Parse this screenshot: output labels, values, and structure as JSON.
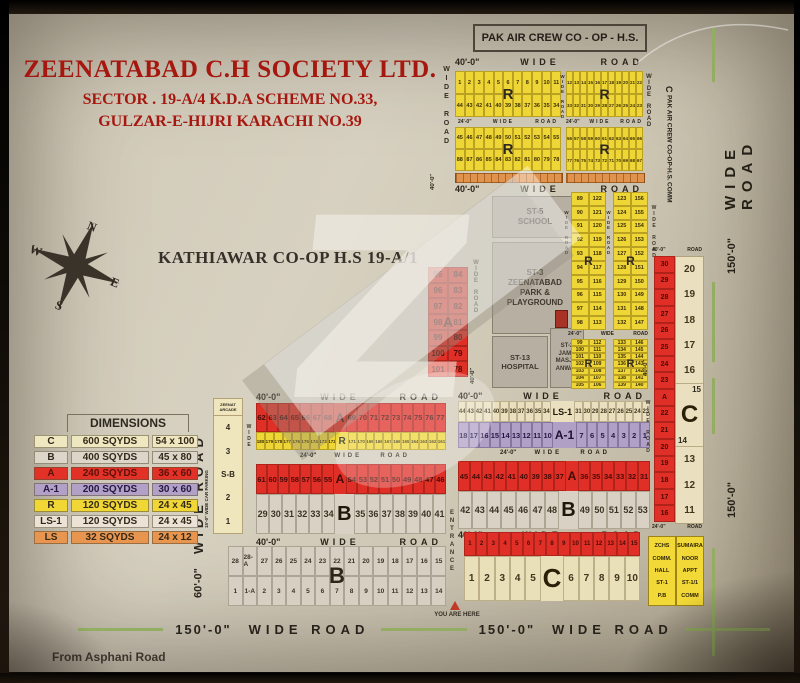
{
  "title": {
    "line1": "ZEENATABAD C.H SOCIETY LTD.",
    "line2": "SECTOR . 19-A/4 K.D.A SCHEME NO.33,",
    "line3": "GULZAR-E-HIJRI KARACHI NO.39"
  },
  "landmarks": {
    "pak_air": "PAK AIR CREW CO - OP - H.S.",
    "pak_air_comm_c": "C",
    "pak_air_comm": "PAK AIR CREW CO-OP-H.S.",
    "pak_air_comm2": "COMM",
    "kathiawar": "KATHIAWAR CO-OP H.S 19-A/1",
    "from_road": "From Asphani Road",
    "you_are_here": "YOU ARE HERE",
    "entrance": "ENTRANCE",
    "watermark": "Z"
  },
  "roads": {
    "wide_road": "WIDE ROAD",
    "wide": "WIDE",
    "road": "ROAD",
    "d40": "40'-0\"",
    "d24": "24'-0\"",
    "d60": "60'-0\"",
    "d150": "150'-0\"",
    "parking": "15'-0\" WIDE CAR PARKING"
  },
  "compass": {
    "n": "N",
    "e": "E",
    "s": "S",
    "w": "W"
  },
  "legend": {
    "title": "DIMENSIONS",
    "rows": [
      {
        "code": "C",
        "area": "600 SQYDS",
        "size": "54 x 100",
        "color": "#efe7c0"
      },
      {
        "code": "B",
        "area": "400 SQYDS",
        "size": "45 x 80",
        "color": "#dcd5c9"
      },
      {
        "code": "A",
        "area": "240 SQYDS",
        "size": "36 x 60",
        "color": "#e23127"
      },
      {
        "code": "A-1",
        "area": "200 SQYDS",
        "size": "30 x 60",
        "color": "#b2a0c6"
      },
      {
        "code": "R",
        "area": "120 SQYDS",
        "size": "24 x 45",
        "color": "#f0d735"
      },
      {
        "code": "LS-1",
        "area": "120 SQYDS",
        "size": "24 x 45",
        "color": "#ece3d6"
      },
      {
        "code": "LS",
        "area": "32 SQYDS",
        "size": "24 x 12",
        "color": "#e8964f"
      }
    ]
  },
  "top_r": [
    {
      "label": "R",
      "row1": [
        1,
        2,
        3,
        4,
        5,
        6,
        7,
        8,
        9,
        10,
        11
      ],
      "row2": [
        44,
        43,
        42,
        41,
        40,
        39,
        38,
        37,
        36,
        35,
        34
      ]
    },
    {
      "label": "R",
      "row1": [
        12,
        13,
        14,
        15,
        16,
        17,
        18,
        19,
        20,
        21,
        22
      ],
      "row2": [
        33,
        32,
        31,
        30,
        29,
        28,
        27,
        26,
        25,
        24,
        23
      ]
    },
    {
      "label": "R",
      "row1": [
        45,
        46,
        47,
        48,
        49,
        50,
        51,
        52,
        53,
        54,
        55
      ],
      "row2": [
        88,
        87,
        86,
        85,
        84,
        83,
        82,
        81,
        80,
        79,
        78
      ]
    },
    {
      "label": "R",
      "row1": [
        56,
        57,
        58,
        59,
        60,
        61,
        62,
        63,
        64,
        65,
        66
      ],
      "row2": [
        77,
        76,
        75,
        74,
        73,
        72,
        71,
        70,
        69,
        68,
        67
      ]
    }
  ],
  "facilities": {
    "st5": [
      "ST-5",
      "SCHOOL"
    ],
    "st3": [
      "ST-3",
      "ZEENATABAD",
      "PARK &",
      "PLAYGROUND"
    ],
    "st13": [
      "ST-13",
      "HOSPITAL"
    ],
    "st2": [
      "ST-2",
      "JAMA",
      "MASJID",
      "ANWAR"
    ]
  },
  "quadrants": [
    {
      "label": "R",
      "c1": [
        89,
        90,
        91,
        92,
        93,
        94,
        95,
        96,
        97,
        98
      ],
      "c2": [
        122,
        121,
        120,
        119,
        118,
        117,
        116,
        115,
        114,
        113
      ]
    },
    {
      "label": "R",
      "c1": [
        123,
        124,
        125,
        126,
        127,
        128,
        129,
        130,
        131,
        132
      ],
      "c2": [
        156,
        155,
        154,
        153,
        152,
        151,
        150,
        149,
        148,
        147
      ]
    },
    {
      "label": "R",
      "c1": [
        99,
        100,
        101,
        102,
        103,
        104,
        105
      ],
      "c2": [
        112,
        111,
        110,
        109,
        108,
        107,
        106
      ]
    },
    {
      "label": "R",
      "c1": [
        133,
        134,
        135,
        136,
        137,
        138,
        139
      ],
      "c2": [
        146,
        145,
        144,
        143,
        142,
        141,
        140
      ]
    }
  ],
  "left_a": {
    "label": "A",
    "c1": [
      95,
      96,
      97,
      98,
      99,
      100,
      101
    ],
    "c2": [
      84,
      83,
      82,
      81,
      80,
      79,
      78
    ]
  },
  "central_left": {
    "a_top": {
      "label": "A",
      "left": [
        62,
        63,
        64,
        65,
        66,
        67,
        68
      ],
      "right": [
        69,
        70,
        71,
        72,
        73,
        74,
        75,
        76,
        77
      ]
    },
    "r_strip": {
      "label": "R",
      "left": [
        180,
        179,
        178,
        177,
        176,
        175,
        174,
        173,
        172
      ],
      "right": [
        171,
        170,
        169,
        168,
        167,
        166,
        165,
        164,
        163,
        162,
        161
      ]
    },
    "a_bot": {
      "label": "A",
      "left": [
        61,
        60,
        59,
        58,
        57,
        56,
        55
      ],
      "right": [
        54,
        53,
        52,
        51,
        50,
        49,
        48,
        47,
        46
      ]
    },
    "b_strip": {
      "label": "B",
      "left": [
        29,
        30,
        31,
        32,
        33,
        34
      ],
      "right": [
        35,
        36,
        37,
        38,
        39,
        40,
        41
      ]
    }
  },
  "central_right": {
    "ls1": {
      "label": "LS-1",
      "left": [
        44,
        43,
        42,
        41,
        40,
        39,
        38,
        37,
        36,
        35,
        34
      ],
      "right": [
        31,
        30,
        29,
        28,
        27,
        26,
        25,
        24,
        23
      ]
    },
    "a1": {
      "label": "A-1",
      "left": [
        18,
        17,
        16,
        15,
        14,
        13,
        12,
        11,
        10
      ],
      "right": [
        7,
        6,
        5,
        4,
        3,
        2,
        1
      ]
    },
    "a2": {
      "label": "A",
      "left": [
        45,
        44,
        43,
        42,
        41,
        40,
        39,
        38,
        37
      ],
      "right": [
        36,
        35,
        34,
        33,
        32,
        31
      ]
    },
    "b2": {
      "label": "B",
      "left": [
        42,
        43,
        44,
        45,
        46,
        47,
        48
      ],
      "right": [
        49,
        50,
        51,
        52,
        53
      ]
    }
  },
  "right_section": {
    "red_cells": [
      30,
      29,
      28,
      27,
      26,
      25,
      24,
      23,
      "A",
      22,
      21,
      20,
      19,
      18,
      17,
      16
    ],
    "c_top": [
      20,
      19,
      18,
      17,
      16
    ],
    "c_label": "C",
    "c_side_top": "15",
    "c_side_bottom": "14",
    "c_bottom": [
      13,
      12,
      11
    ]
  },
  "sb_block": {
    "header": [
      "ZEENAT",
      "ARCADE"
    ],
    "cells": [
      "4",
      "3",
      "S-B",
      "2",
      "1"
    ]
  },
  "bottom_b": {
    "label": "B",
    "row1": [
      28,
      "28-A",
      27,
      26,
      25,
      24,
      23,
      22,
      21,
      20,
      19,
      18,
      17,
      16,
      15
    ],
    "row2": [
      1,
      "1-A",
      2,
      3,
      4,
      5,
      6,
      7,
      8,
      9,
      10,
      11,
      12,
      13,
      14
    ]
  },
  "bottom_c": {
    "red": [
      1,
      2,
      3,
      4,
      5,
      6,
      7,
      8,
      9,
      10,
      11,
      12,
      13,
      14,
      15
    ],
    "label": "C",
    "left": [
      1,
      2,
      3,
      4,
      5
    ],
    "right": [
      6,
      7,
      8,
      9,
      10
    ]
  },
  "zchs": [
    "ZCHS",
    "COMM.",
    "HALL",
    "ST-1",
    "P.B"
  ],
  "sumaira": [
    "SUMAIRA",
    "NOOR",
    "APPT",
    "ST-1/1",
    "COMM"
  ]
}
